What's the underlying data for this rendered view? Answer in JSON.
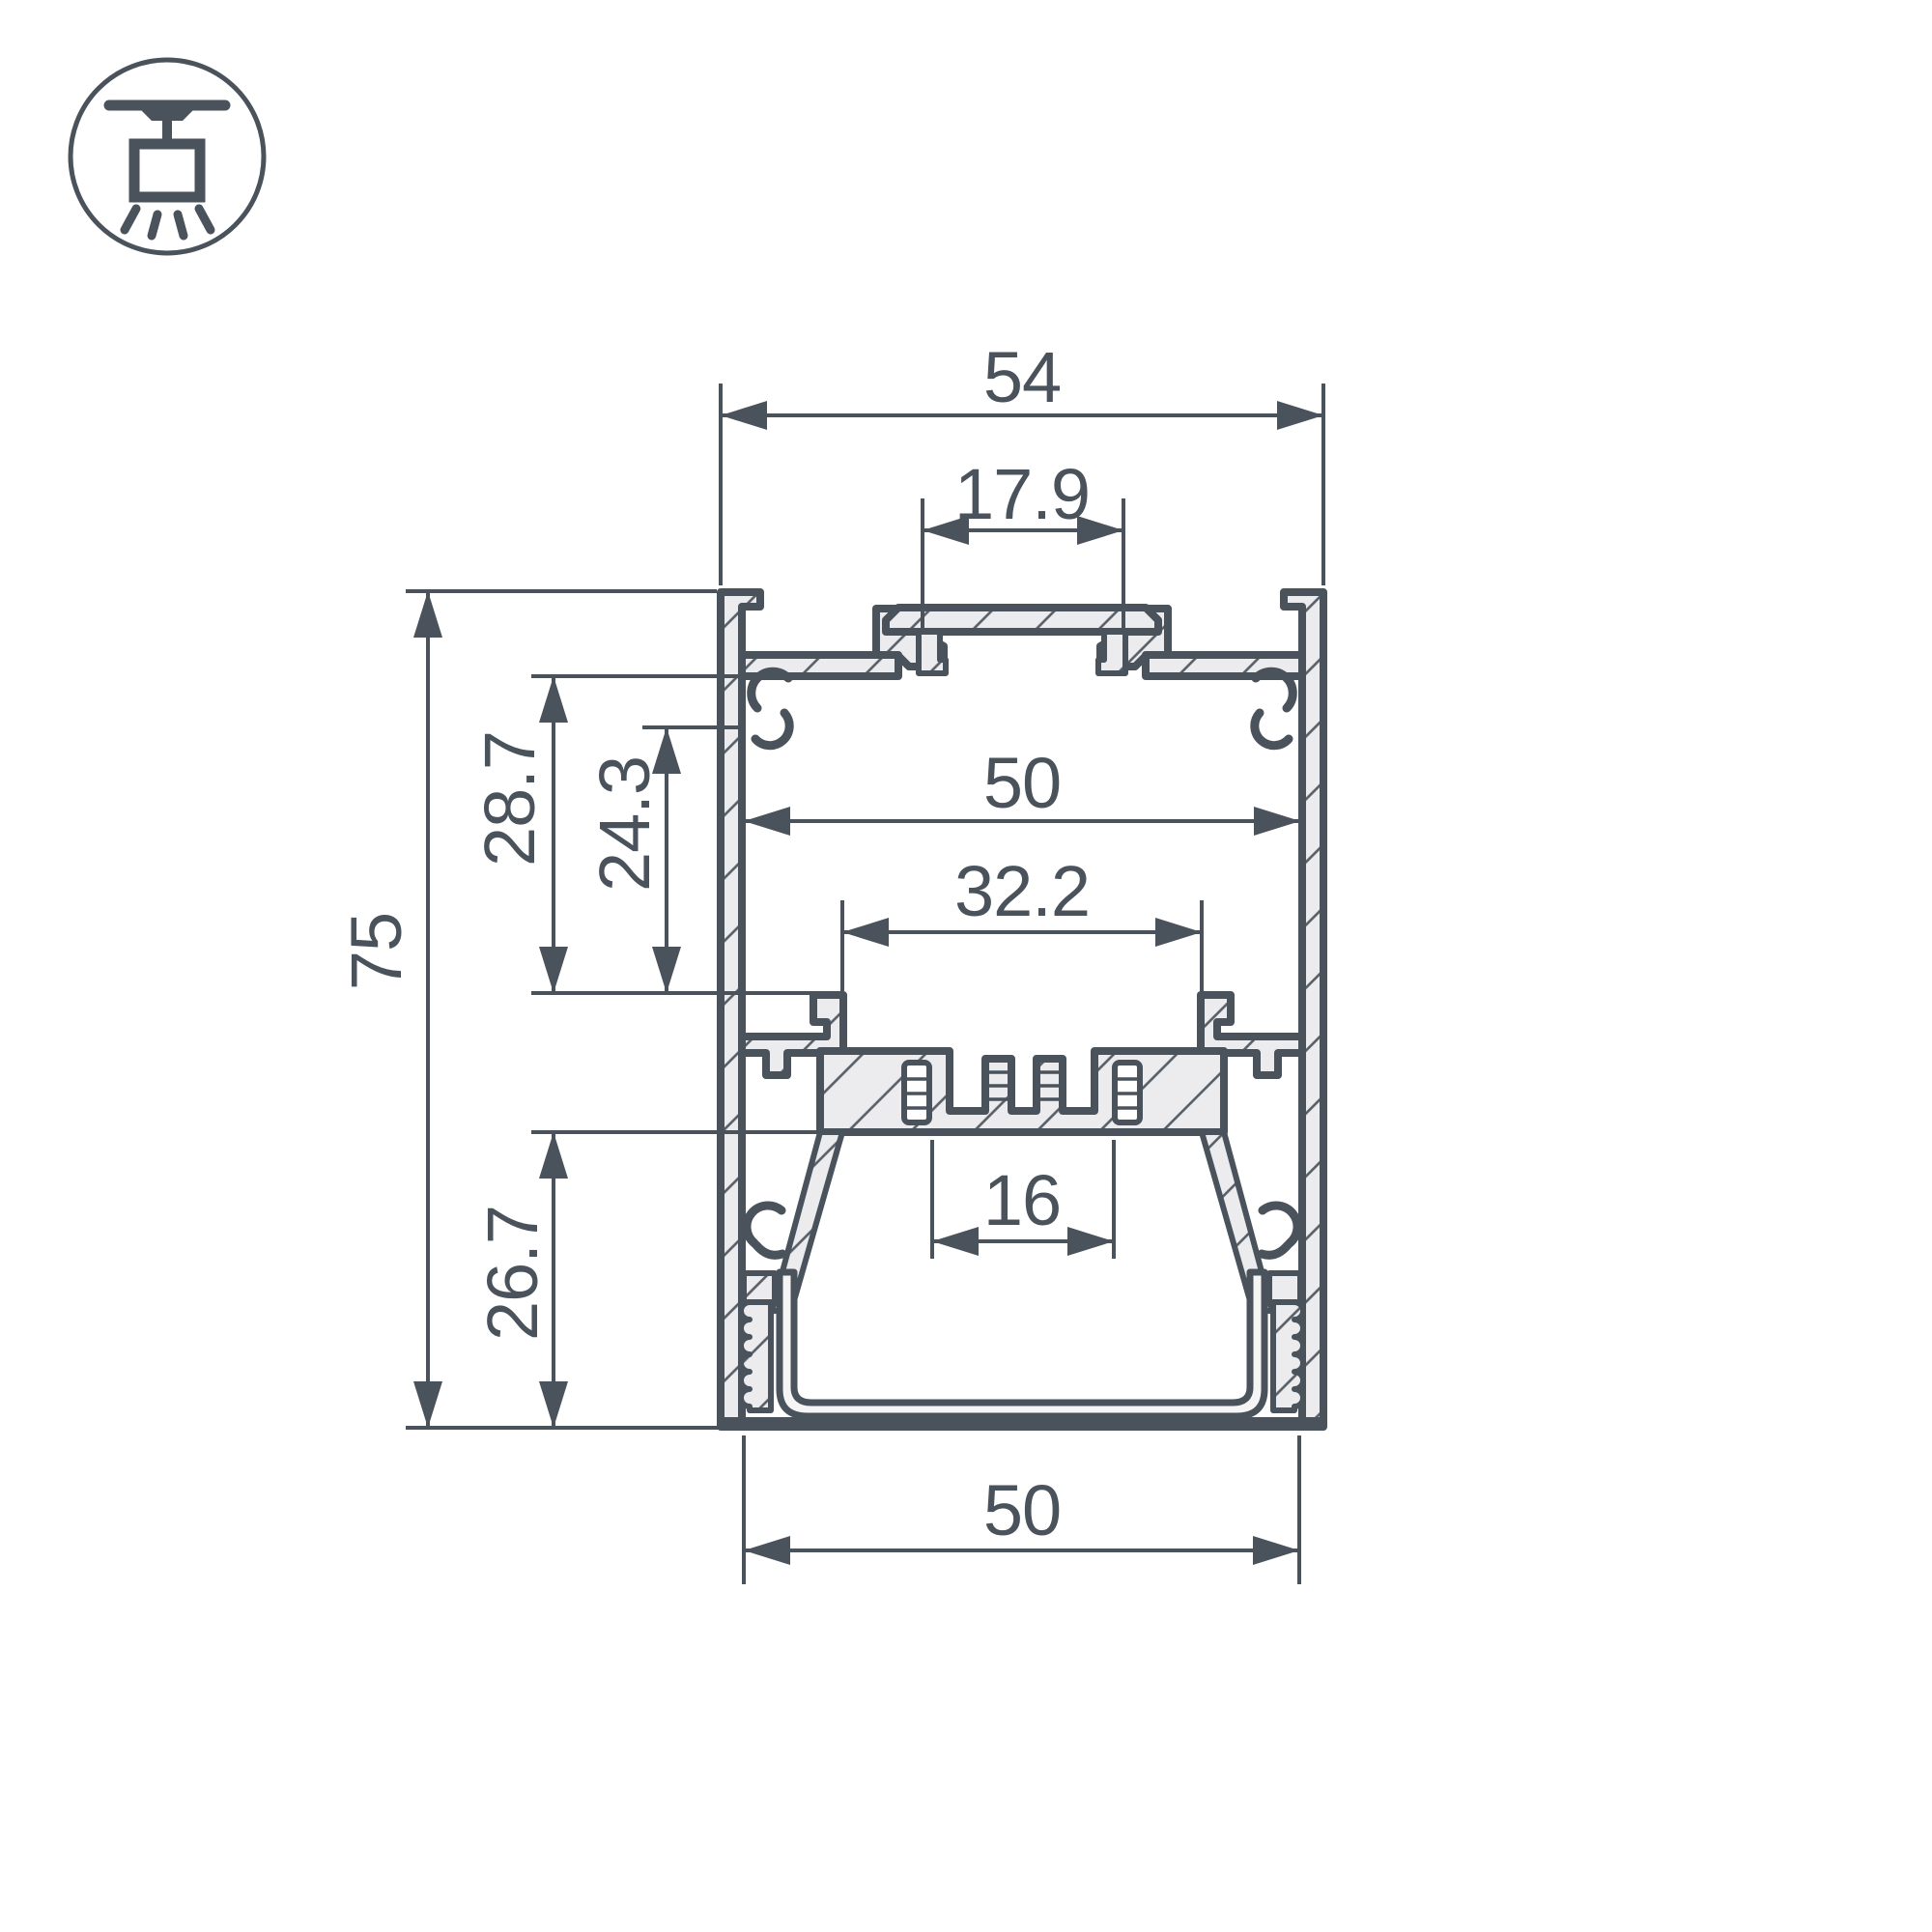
{
  "drawing": {
    "type": "profile-cross-section",
    "icon": "ceiling-pendant-mount-icon",
    "colors": {
      "line": "#4a525b",
      "aluminum_fill": "#ececee",
      "diffuser_fill": "#f5f5f6",
      "background": "#ffffff"
    },
    "dimensions": {
      "outer_width": "54",
      "mount_slot_width": "17.9",
      "inner_width": "50",
      "heatsink_width": "32.2",
      "strip_slot_width": "16",
      "bottom_inner_width": "50",
      "overall_height": "75",
      "upper_cavity_depth": "28.7",
      "mount_cavity_depth": "24.3",
      "lower_cavity_depth": "26.7"
    }
  }
}
